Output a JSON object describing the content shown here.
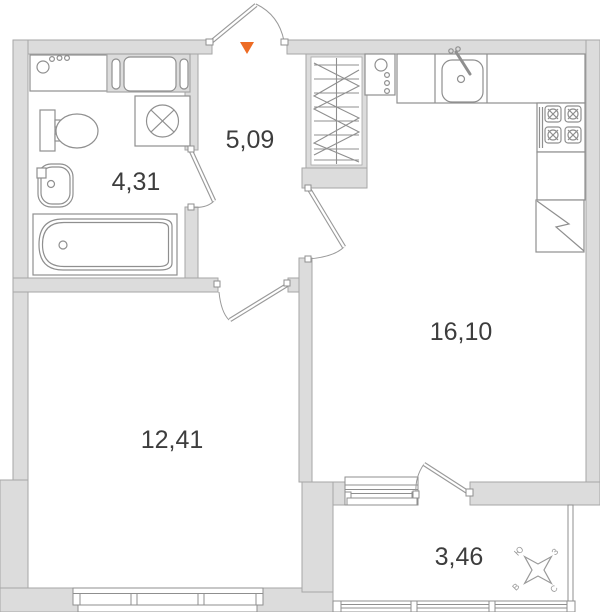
{
  "floor_plan": {
    "type": "apartment-floor-plan",
    "rooms": {
      "bathroom": {
        "label": "4,31"
      },
      "hallway": {
        "label": "5,09"
      },
      "kitchen_living": {
        "label": "16,10"
      },
      "bedroom": {
        "label": "12,41"
      },
      "balcony": {
        "label": "3,46"
      }
    },
    "compass": {
      "south": "Ю",
      "west": "З",
      "east": "В",
      "north": "С"
    },
    "entrance": {
      "marker_shape": "triangle-down",
      "color": "#ed6b24"
    },
    "fixtures": [
      "washing-machine",
      "ventilation-shaft",
      "extractor-fan",
      "toilet",
      "wash-basin",
      "bathtub",
      "wardrobe",
      "water-heater",
      "kitchen-counter",
      "kitchen-sink",
      "gas-stove",
      "refrigerator",
      "window",
      "balcony-glazing"
    ],
    "colors": {
      "wall_fill": "#dcdcdc",
      "wall_stroke": "#a6a6a6",
      "fixture_stroke": "#8f8f8f",
      "door_stroke": "#9a9a9a",
      "label_text": "#3d3d3d"
    }
  }
}
